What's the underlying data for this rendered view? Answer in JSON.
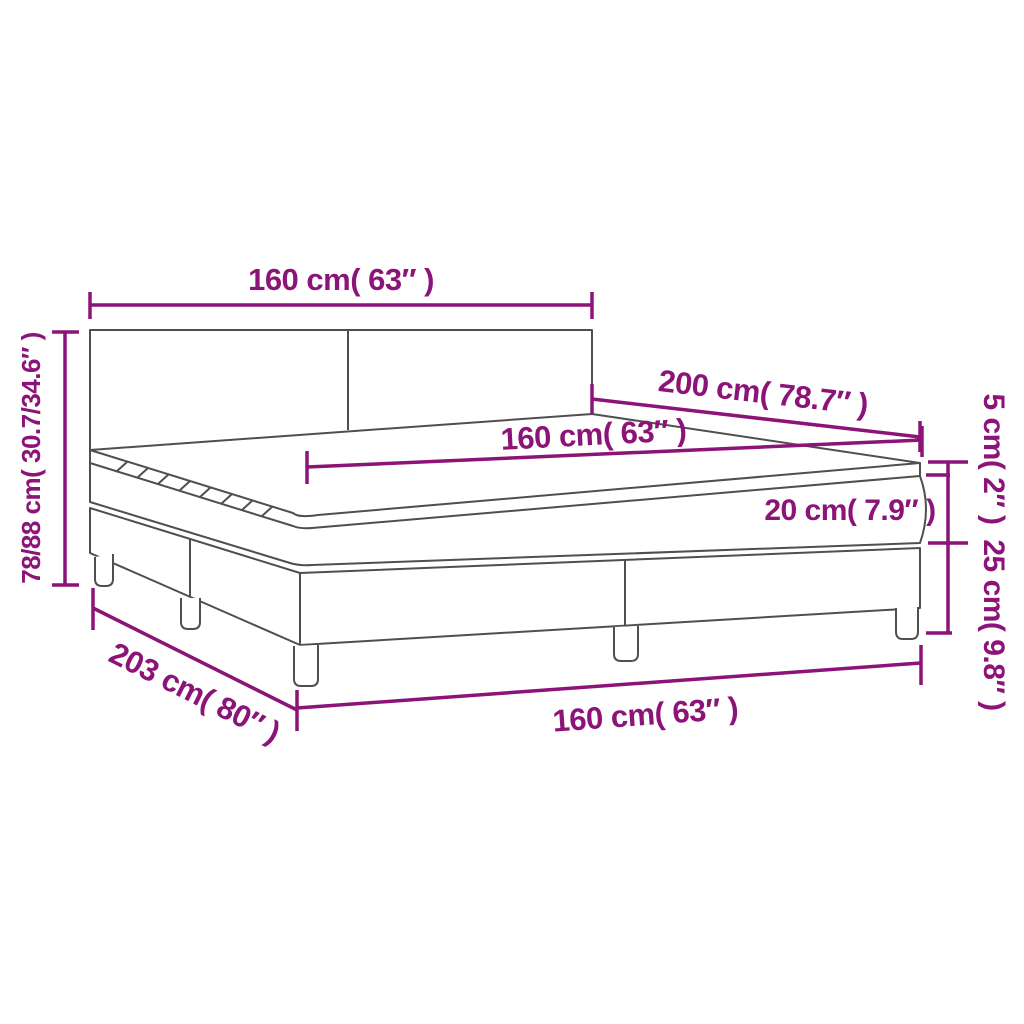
{
  "diagram": {
    "type": "product-dimension-diagram",
    "subject": "box spring bed with headboard, topper, mattress and two-piece base on legs",
    "colors": {
      "dimension_accent": "#8c1377",
      "outline": "#4f4f4f",
      "background": "#ffffff"
    },
    "labels": {
      "headboard_width": "160 cm( 63″ )",
      "total_height": "78/88 cm( 30.7/34.6″ )",
      "mattress_length": "200 cm( 78.7″ )",
      "mattress_width": "160 cm( 63″ )",
      "mattress_height": "20 cm( 7.9″ )",
      "topper_height": "5 cm( 2″ )",
      "base_height": "25 cm( 9.8″ )",
      "total_length": "203 cm( 80″ )",
      "base_width": "160 cm( 63″ )"
    }
  }
}
